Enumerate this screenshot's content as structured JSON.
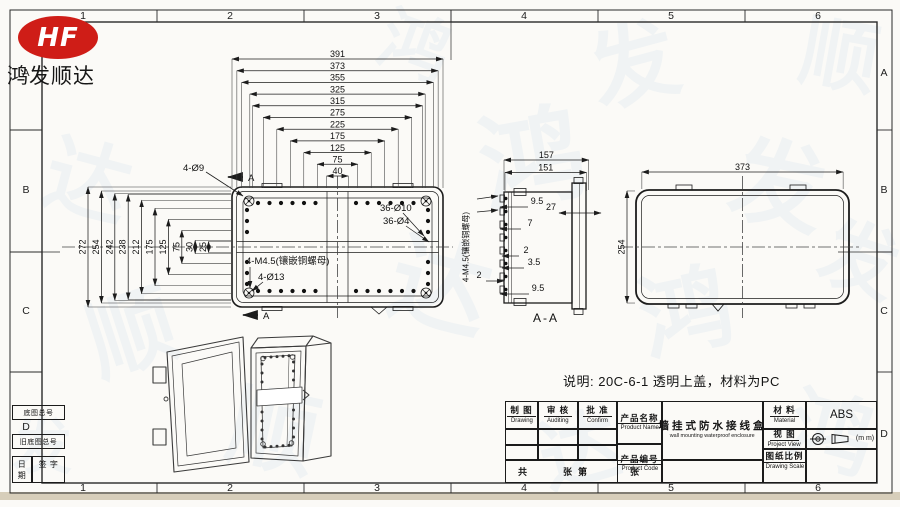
{
  "sheet": {
    "grid_columns": [
      "1",
      "2",
      "3",
      "4",
      "5",
      "6"
    ],
    "grid_rows": [
      "A",
      "B",
      "C",
      "D"
    ]
  },
  "logo": {
    "monogram": "HF",
    "company": "鸿发顺达",
    "ellipse_color": "#cf1d17"
  },
  "note": "说明: 20C-6-1 透明上盖，材料为PC",
  "watermark": {
    "chars": [
      "鸿",
      "发",
      "顺",
      "达"
    ],
    "color": "#7aa6d4"
  },
  "views": {
    "plan": {
      "top_dims": [
        "391",
        "373",
        "355",
        "325",
        "315",
        "275",
        "225",
        "175",
        "125",
        "75",
        "40"
      ],
      "left_dims": [
        "272",
        "254",
        "242",
        "238",
        "212",
        "175",
        "125",
        "75",
        "30",
        "25"
      ],
      "labels": {
        "corner_holes": "4-Ø9",
        "outer_holes": "36-Ø10",
        "inner_holes": "36-Ø4",
        "insert_nut": "4-M4.5(镶嵌铜螺母)",
        "feet_holes": "4-Ø13",
        "section_letter": "A"
      }
    },
    "section": {
      "caption": "A-A",
      "width_dims": [
        "157",
        "151"
      ],
      "side_label": "4-M4.5(镶嵌铜螺母)",
      "detail_dims": [
        "9.5",
        "7",
        "27",
        "2",
        "3.5",
        "2",
        "9.5"
      ]
    },
    "lid": {
      "width": "373",
      "height": "254"
    }
  },
  "title_block": {
    "drawing": {
      "zh": "制 图",
      "en": "Drawing"
    },
    "auditing": {
      "zh": "审 核",
      "en": "Auditing"
    },
    "confirm": {
      "zh": "批 准",
      "en": "Confirm"
    },
    "product_name_label": {
      "zh": "产品名称",
      "en": "Product Name"
    },
    "product_name": {
      "zh": "墙挂式防水接线盒",
      "en": "wall mounting waterproof enclosure"
    },
    "product_code_label": {
      "zh": "产品编号",
      "en": "Product Code"
    },
    "material_label": {
      "zh": "材 料",
      "en": "Material"
    },
    "material_value": "ABS",
    "view_label": {
      "zh": "视 图",
      "en": "Project View"
    },
    "scale_label": {
      "zh": "图纸比例",
      "en": "Drawing Scale"
    },
    "unit": "(m m)",
    "sheet_row": {
      "total": "共",
      "sheet": "张",
      "no": "第",
      "sheet2": "张"
    }
  },
  "margin_block": {
    "base_no": "底图总号",
    "old_base_no": "旧底图总号",
    "date_top": "日",
    "date_bottom": "期",
    "signature": "签 字"
  }
}
